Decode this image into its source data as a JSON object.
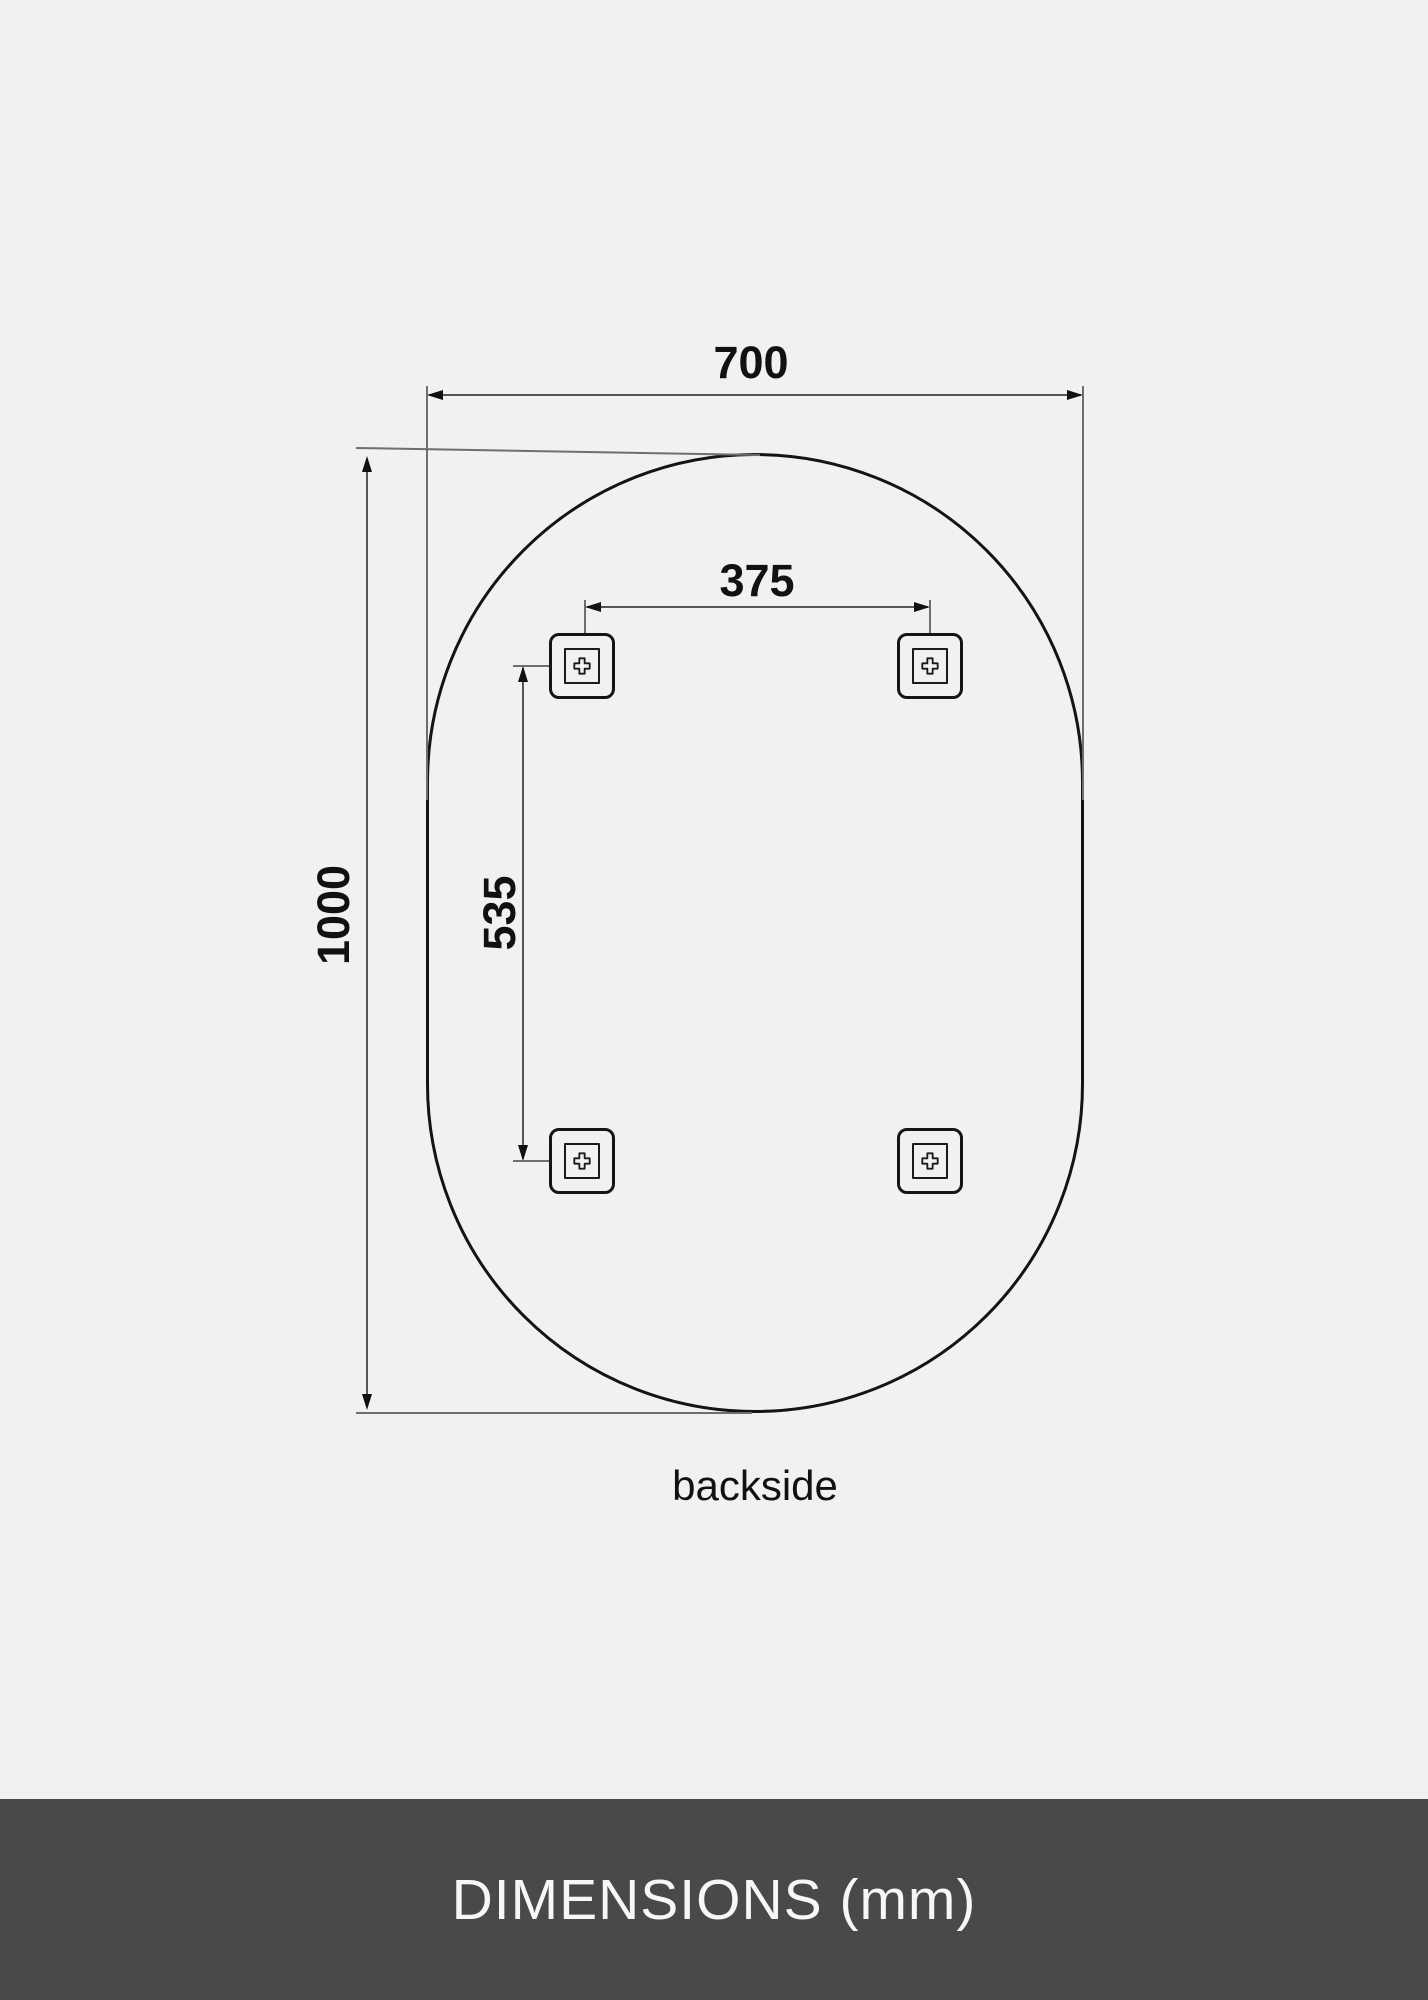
{
  "diagram": {
    "view_label": "backside",
    "dimensions": {
      "overall_width_mm": "700",
      "overall_height_mm": "1000",
      "bracket_spacing_horizontal_mm": "375",
      "bracket_spacing_vertical_mm": "535"
    },
    "bracket_count": 4,
    "icons": {
      "screw_cross_icon": "outlined plus (screw mount)"
    }
  },
  "footer": {
    "title": "DIMENSIONS (mm)"
  },
  "colors": {
    "background": "#f1f1f1",
    "outline_dark": "#141414",
    "dimension_line": "#555555",
    "extension_line": "#6e6e6e",
    "label_text": "#111111",
    "footer_background": "#494949",
    "footer_text": "#f7f7f7"
  }
}
